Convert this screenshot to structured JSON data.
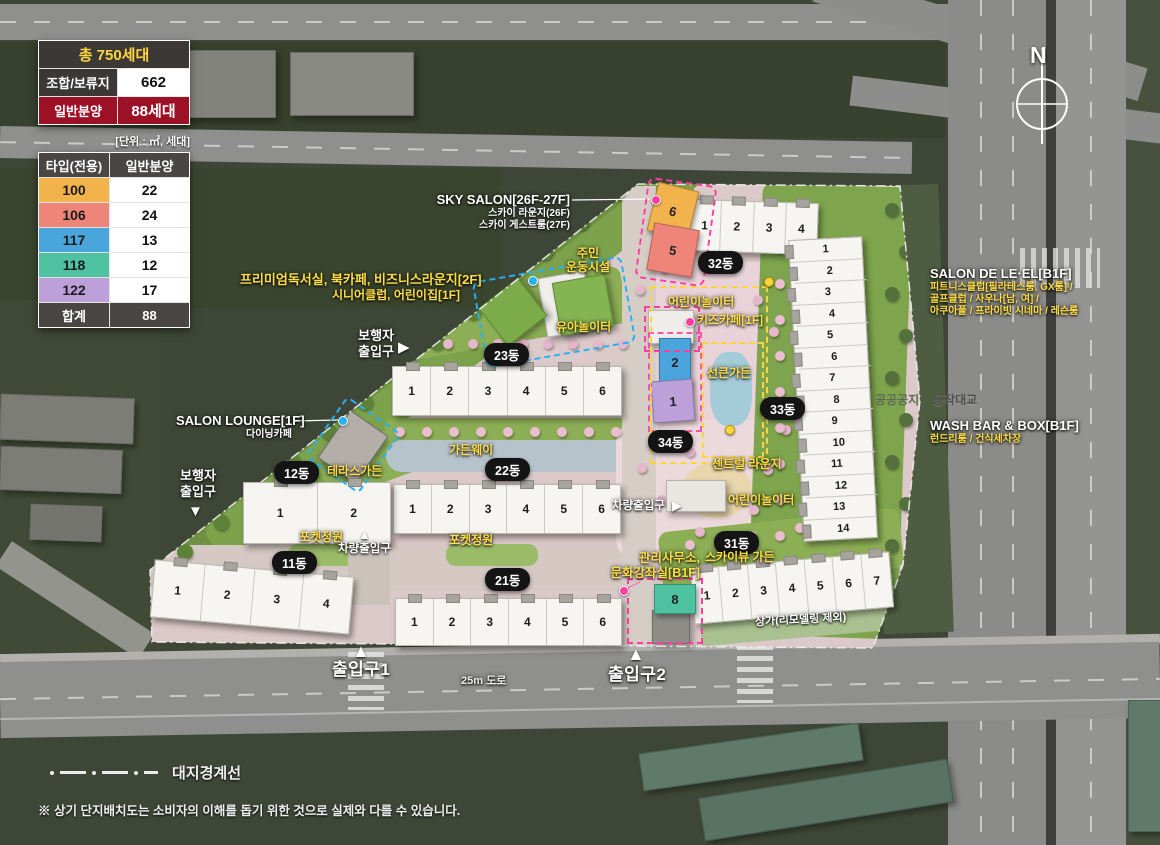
{
  "summary_table": {
    "title": "총 750세대",
    "rows": [
      {
        "label": "조합/보류지",
        "value": "662"
      },
      {
        "label": "일반분양",
        "value": "88세대"
      }
    ],
    "unit_note": "[단위 : ㎡, 세대]",
    "accent_color": "#9d1126"
  },
  "type_table": {
    "col1": "타입(전용)",
    "col2": "일반분양",
    "rows": [
      {
        "type": "100",
        "count": "22",
        "color": "#f2b24c"
      },
      {
        "type": "106",
        "count": "24",
        "color": "#ef8579"
      },
      {
        "type": "117",
        "count": "13",
        "color": "#4aa5dc"
      },
      {
        "type": "118",
        "count": "12",
        "color": "#4fc2a2"
      },
      {
        "type": "122",
        "count": "17",
        "color": "#bda0da"
      }
    ],
    "total_label": "합계",
    "total_value": "88"
  },
  "compass": {
    "north": "N"
  },
  "buildings": {
    "b11": {
      "label": "11동",
      "units": [
        "1",
        "2",
        "3",
        "4"
      ]
    },
    "b12": {
      "label": "12동",
      "units": [
        "1",
        "2"
      ]
    },
    "b21": {
      "label": "21동",
      "units": [
        "1",
        "2",
        "3",
        "4",
        "5",
        "6"
      ]
    },
    "b22": {
      "label": "22동",
      "units": [
        "1",
        "2",
        "3",
        "4",
        "5",
        "6"
      ]
    },
    "b23": {
      "label": "23동",
      "units": [
        "1",
        "2",
        "3",
        "4",
        "5",
        "6"
      ]
    },
    "b31": {
      "label": "31동",
      "units": [
        "1",
        "2",
        "3",
        "4",
        "5",
        "6",
        "7"
      ]
    },
    "b32": {
      "label": "32동",
      "units": [
        "1",
        "2",
        "3",
        "4"
      ]
    },
    "b33": {
      "label": "33동",
      "units": [
        "1",
        "2",
        "3",
        "4",
        "5",
        "6",
        "7",
        "8",
        "9",
        "10",
        "11",
        "12",
        "13",
        "14"
      ]
    },
    "b34": {
      "label": "34동"
    }
  },
  "sale_units": {
    "u6": {
      "no": "6",
      "color": "#f2b24c"
    },
    "u5": {
      "no": "5",
      "color": "#ef8579"
    },
    "u2": {
      "no": "2",
      "color": "#4aa5dc"
    },
    "u1": {
      "no": "1",
      "color": "#bda0da"
    },
    "u8": {
      "no": "8",
      "color": "#4fc2a2"
    }
  },
  "facility_labels": {
    "sky_salon_title": "SKY SALON[26F-27F]",
    "sky_salon_sub1": "스카이 라운지(26F)",
    "sky_salon_sub2": "스카이 게스트룸(27F)",
    "premium_line1": "프리미엄독서실, 북카페, 비즈니스라운지[2F]",
    "premium_line2": "시니어클럽, 어린이집[1F]",
    "salon_lounge_title": "SALON LOUNGE[1F]",
    "salon_lounge_sub": "다이닝카페",
    "salon_de_title": "SALON DE LE·EL[B1F]",
    "salon_de_sub1": "피트니스클럽[필라테스룸, GX룸] /",
    "salon_de_sub2": "골프클럽 / 사우나[남, 여] /",
    "salon_de_sub3": "아쿠아풀 / 프라이빗 시네마 / 레슨룸",
    "wash_bar_title": "WASH BAR & BOX[B1F]",
    "wash_bar_sub": "런드리룸 / 건식세차장",
    "mgmt_line1": "관리사무소,",
    "mgmt_line2": "문화강좌실[B1F]",
    "kids_cafe": "키즈카페[1F]",
    "jumin_line1": "주민",
    "jumin_line2": "운동시설"
  },
  "area_labels": {
    "yua": "유아놀이터",
    "children_top": "어린이놀이터",
    "children_bottom": "어린이놀이터",
    "sunken": "선큰가든",
    "central": "센트럴 라운지",
    "skyview": "스카이뷰 가든",
    "terrace": "테라스가든",
    "gardenway": "가든웨이",
    "pocket1": "포켓정원",
    "pocket2": "포켓정원",
    "shop": "상가(리모델링 제외)"
  },
  "gate_labels": {
    "ped_line1": "보행자",
    "ped_line2": "출입구",
    "vehicle": "차량출입구",
    "gate1": "출입구1",
    "gate2": "출입구2"
  },
  "road_labels": {
    "road25": "25m 도로",
    "bridge": "동작대교",
    "public": "공공공지"
  },
  "footer": {
    "boundary_legend": "대지경계선",
    "disclaimer": "※ 상기 단지배치도는 소비자의 이해를 돕기 위한 것으로 실제와 다를 수 있습니다."
  }
}
